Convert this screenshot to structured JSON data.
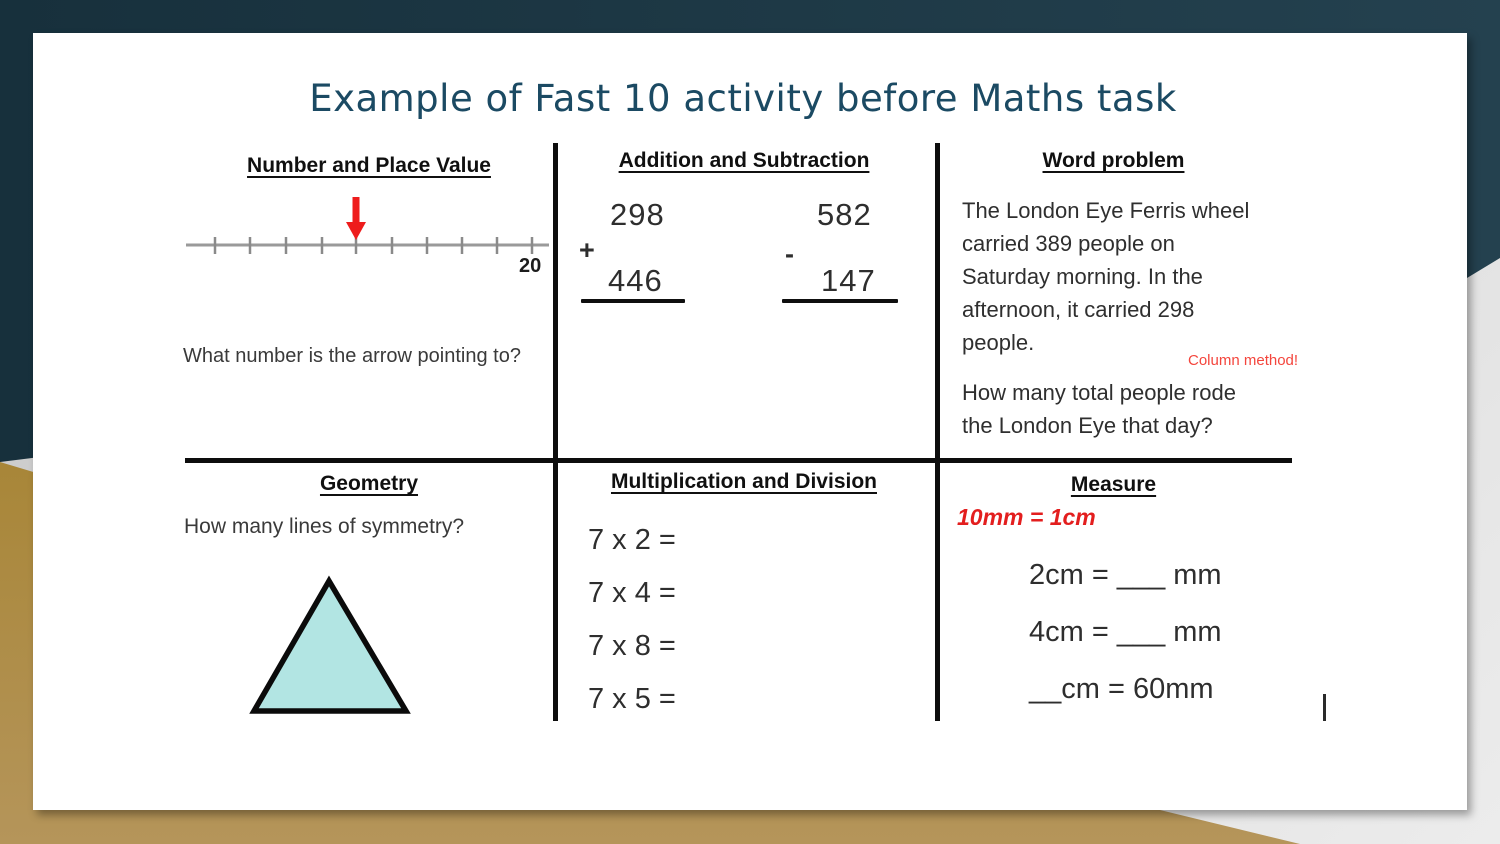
{
  "slide": {
    "title": "Example of Fast 10 activity before Maths task"
  },
  "sections": {
    "number_place_value": {
      "header": "Number and Place Value",
      "number_line": {
        "end_label": "20",
        "tick_count": 10,
        "arrow_tick_index": 4
      },
      "question": "What number is the arrow pointing to?"
    },
    "addition_subtraction": {
      "header": "Addition and Subtraction",
      "addition": {
        "operator": "+",
        "top": "298",
        "bottom": "446"
      },
      "subtraction": {
        "operator": "-",
        "top": "582",
        "bottom": "147"
      }
    },
    "word_problem": {
      "header": "Word problem",
      "body": "The London Eye Ferris wheel\ncarried 389 people on\nSaturday morning. In the\nafternoon, it carried 298\npeople.",
      "hint": "Column method!",
      "question": "How many total people rode\nthe London Eye that day?"
    },
    "geometry": {
      "header": "Geometry",
      "question": "How many lines of symmetry?",
      "shape": "triangle"
    },
    "multiplication_division": {
      "header": "Multiplication and Division",
      "problems": [
        "7 x 2 =",
        "7 x 4 =",
        "7 x 8 =",
        "7 x 5 ="
      ]
    },
    "measure": {
      "header": "Measure",
      "fact": "10mm = 1cm",
      "problems": [
        "2cm = ___ mm",
        "4cm = ___ mm",
        "__cm = 60mm"
      ]
    }
  },
  "colors": {
    "background_teal": "#1d3642",
    "background_gold": "#ad8c46",
    "background_gray": "#d9d9d9",
    "title_text": "#1b4a63",
    "arrow_red": "#ee1c1c",
    "fact_red": "#e31e1e",
    "hint_red": "#f4453c",
    "triangle_fill": "#b2e5e3"
  }
}
